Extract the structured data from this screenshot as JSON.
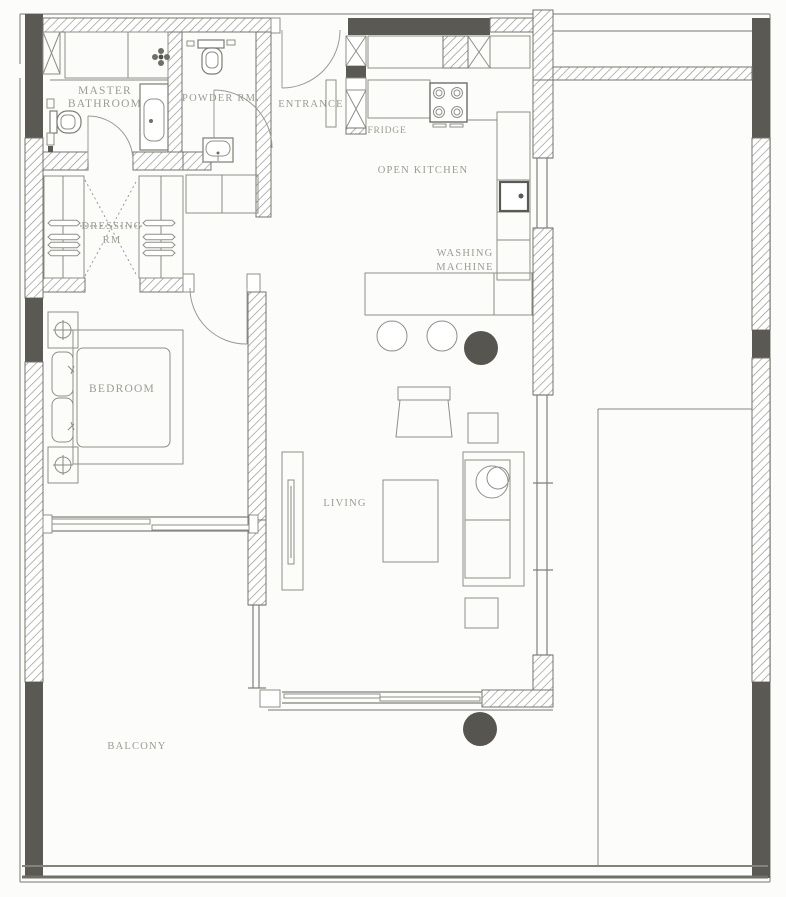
{
  "floorplan": {
    "rooms": {
      "master_bathroom": {
        "line1": "MASTER",
        "line2": "BATHROOM"
      },
      "powder_room": {
        "label": "POWDER RM."
      },
      "entrance": {
        "label": "ENTRANCE"
      },
      "fridge": {
        "label": "FRIDGE"
      },
      "open_kitchen": {
        "label": "OPEN KITCHEN"
      },
      "washing_machine": {
        "line1": "WASHING",
        "line2": "MACHINE"
      },
      "dressing_room": {
        "line1": "DRESSING",
        "line2": "RM"
      },
      "bedroom": {
        "label": "BEDROOM"
      },
      "living": {
        "label": "LIVING"
      },
      "balcony": {
        "label": "BALCONY"
      }
    },
    "icons": {
      "toilet": "toilet-icon",
      "bathtub": "bathtub-icon",
      "sink": "sink-icon",
      "shower": "shower-head-icon",
      "stove": "stove-burners-icon",
      "fridge": "fridge-icon",
      "washing_machine": "washing-machine-icon",
      "wardrobe": "wardrobe-hangers-icon",
      "bed": "double-bed-icon",
      "lamp": "table-lamp-icon",
      "sofa": "sofa-icon",
      "armchair": "armchair-icon",
      "tv": "tv-console-icon",
      "stool": "bar-stool-icon",
      "door": "door-swing-arc",
      "window": "window-double-line",
      "plant": "round-plant-dot"
    },
    "colors": {
      "background": "#fcfcfa",
      "wall_dark": "#5a5954",
      "wall_outline": "#74746d",
      "hatch_line": "#8e8e88",
      "furniture_line": "#8f8f88",
      "label_text": "#9c9c93",
      "accent_dot": "#56554f"
    }
  }
}
